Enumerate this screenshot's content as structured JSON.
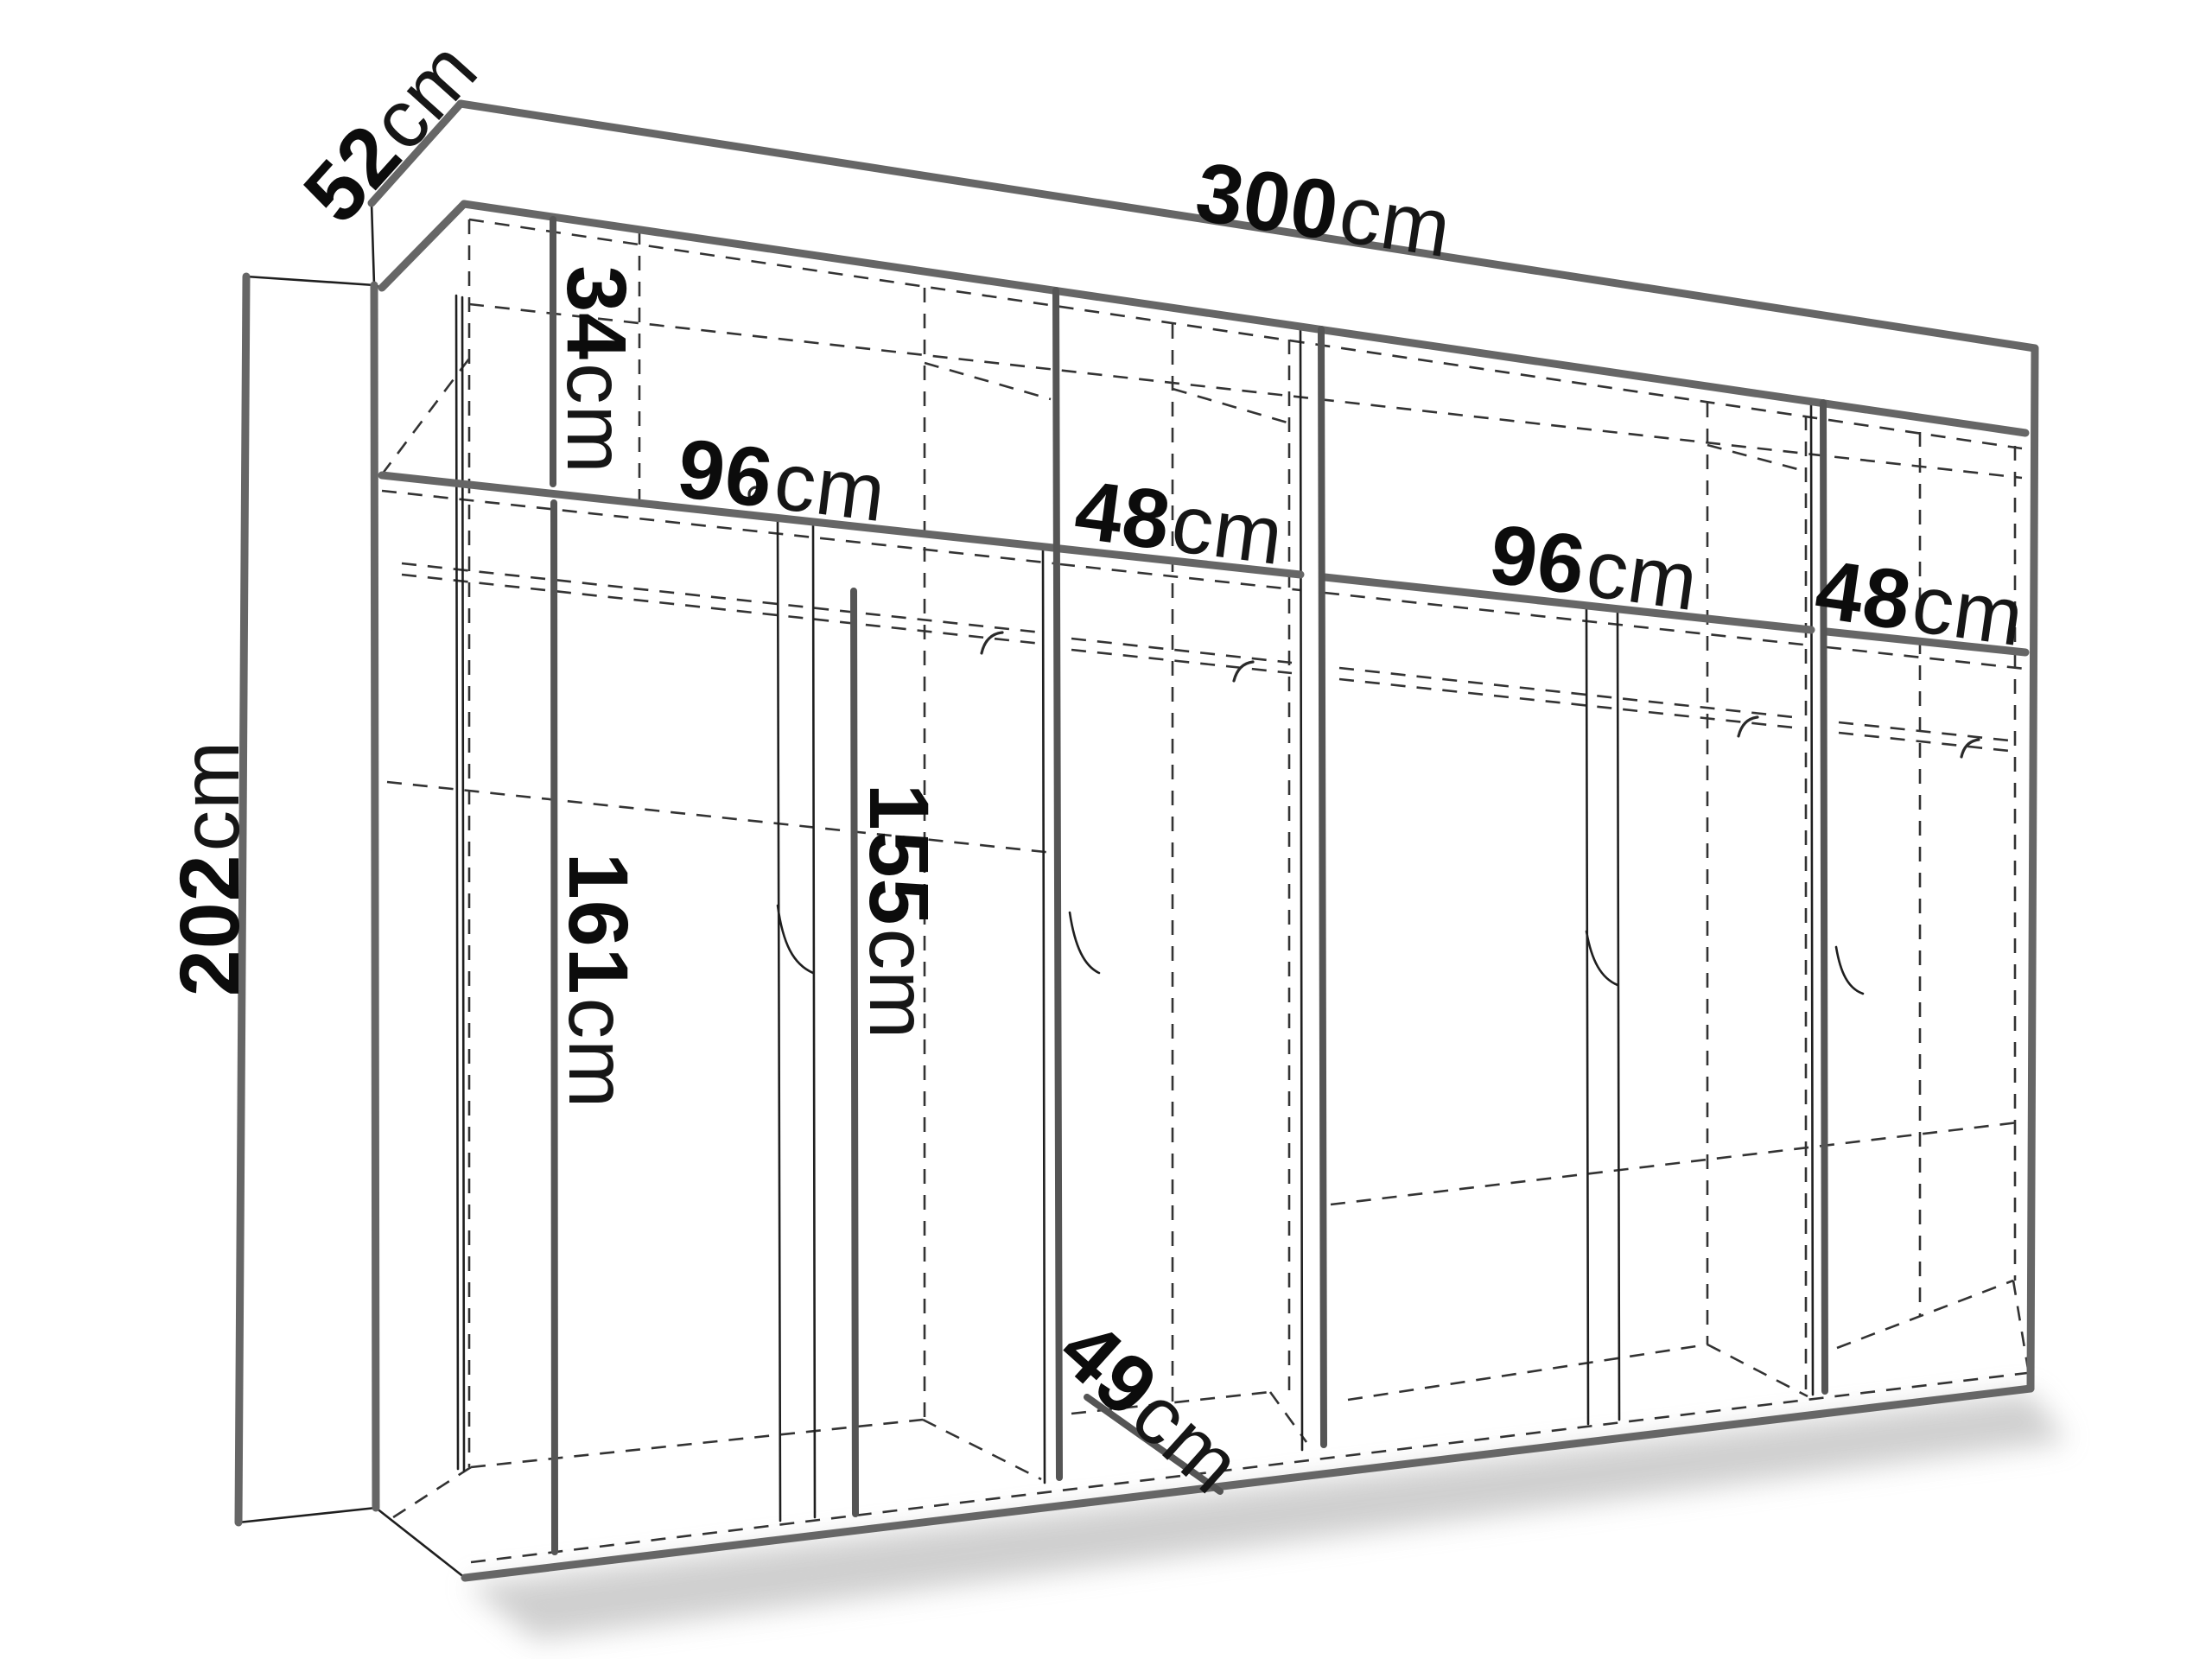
{
  "diagram": {
    "type": "wardrobe-dimension-drawing",
    "labels": {
      "width_total": {
        "value": "300",
        "unit": "cm"
      },
      "depth_total": {
        "value": "52",
        "unit": "cm"
      },
      "height_total": {
        "value": "202",
        "unit": "cm"
      },
      "top_shelf_height": {
        "value": "34",
        "unit": "cm"
      },
      "section1_width": {
        "value": "96",
        "unit": "cm"
      },
      "section2_width": {
        "value": "48",
        "unit": "cm"
      },
      "section3_width": {
        "value": "96",
        "unit": "cm"
      },
      "section4_width": {
        "value": "48",
        "unit": "cm"
      },
      "left_door_height": {
        "value": "161",
        "unit": "cm"
      },
      "hanging_space_height": {
        "value": "155",
        "unit": "cm"
      },
      "interior_depth": {
        "value": "49",
        "unit": "cm"
      }
    }
  }
}
